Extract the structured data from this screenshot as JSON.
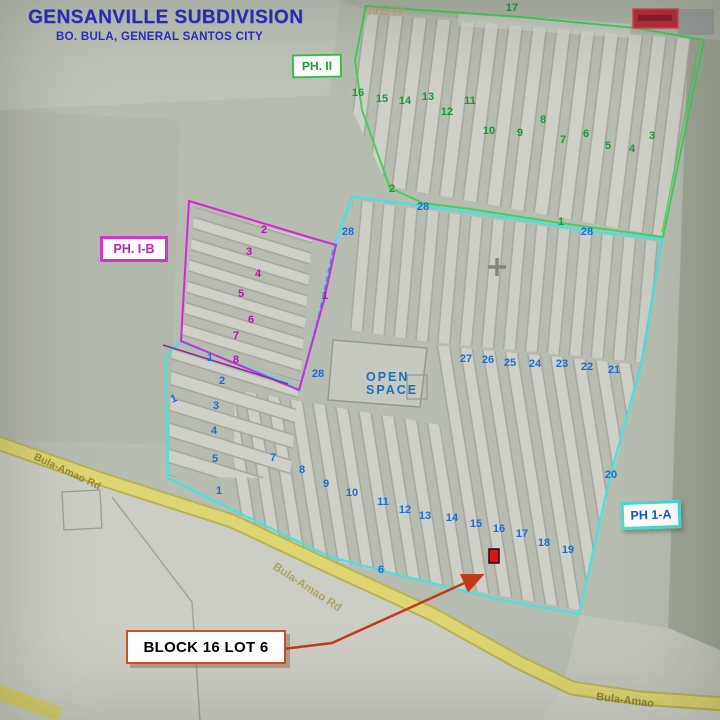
{
  "header": {
    "title": "GENSANVILLE SUBDIVISION",
    "subtitle": "BO. BULA, GENERAL SANTOS CITY"
  },
  "watermark": "NEW",
  "phases": {
    "ph2": {
      "label": "PH. II"
    },
    "ph1b": {
      "label": "PH. I-B"
    },
    "ph1a": {
      "label": "PH 1-A"
    }
  },
  "open_space": {
    "line1": "OPEN",
    "line2": "SPACE"
  },
  "roads": {
    "label_left": "Bula-Amao Rd",
    "label_mid": "Bula-Amao Rd",
    "label_right": "Bula-Amao"
  },
  "callout": {
    "label": "BLOCK 16 LOT 6"
  },
  "colors": {
    "title_blue": "#2a2ac8",
    "phase2_green": "#1f9e35",
    "phase1b_magenta": "#bb22bb",
    "phase1a_cyan": "#46d7d7",
    "block_number_green": "#1d9636",
    "block_number_blue": "#1e6cd4",
    "block_number_magenta": "#b314b3",
    "road_yellow": "#d9d26c",
    "arrow_red": "#c23a1a",
    "target_marker_red": "#e01010"
  },
  "markers": {
    "green": [
      {
        "label": "17",
        "x": 512,
        "y": 8
      },
      {
        "label": "16",
        "x": 358,
        "y": 93
      },
      {
        "label": "15",
        "x": 382,
        "y": 99
      },
      {
        "label": "14",
        "x": 405,
        "y": 101
      },
      {
        "label": "13",
        "x": 428,
        "y": 97
      },
      {
        "label": "12",
        "x": 447,
        "y": 112
      },
      {
        "label": "11",
        "x": 470,
        "y": 101
      },
      {
        "label": "10",
        "x": 489,
        "y": 131
      },
      {
        "label": "9",
        "x": 520,
        "y": 133
      },
      {
        "label": "8",
        "x": 543,
        "y": 120
      },
      {
        "label": "7",
        "x": 563,
        "y": 140
      },
      {
        "label": "6",
        "x": 586,
        "y": 134
      },
      {
        "label": "5",
        "x": 608,
        "y": 146
      },
      {
        "label": "4",
        "x": 632,
        "y": 149
      },
      {
        "label": "3",
        "x": 652,
        "y": 136
      },
      {
        "label": "2",
        "x": 392,
        "y": 189
      },
      {
        "label": "1",
        "x": 561,
        "y": 222
      }
    ],
    "blue": [
      {
        "label": "28",
        "x": 423,
        "y": 207
      },
      {
        "label": "28",
        "x": 348,
        "y": 232
      },
      {
        "label": "28",
        "x": 587,
        "y": 232
      },
      {
        "label": "28",
        "x": 318,
        "y": 374
      },
      {
        "label": "27",
        "x": 466,
        "y": 359
      },
      {
        "label": "26",
        "x": 488,
        "y": 360
      },
      {
        "label": "25",
        "x": 510,
        "y": 363
      },
      {
        "label": "24",
        "x": 535,
        "y": 364
      },
      {
        "label": "23",
        "x": 562,
        "y": 364
      },
      {
        "label": "22",
        "x": 587,
        "y": 367
      },
      {
        "label": "21",
        "x": 614,
        "y": 370
      },
      {
        "label": "20",
        "x": 611,
        "y": 475
      },
      {
        "label": "1",
        "x": 174,
        "y": 399,
        "r": -20
      },
      {
        "label": "1",
        "x": 210,
        "y": 358
      },
      {
        "label": "2",
        "x": 222,
        "y": 381
      },
      {
        "label": "3",
        "x": 216,
        "y": 406
      },
      {
        "label": "4",
        "x": 214,
        "y": 431
      },
      {
        "label": "5",
        "x": 215,
        "y": 459
      },
      {
        "label": "1",
        "x": 219,
        "y": 491
      },
      {
        "label": "7",
        "x": 273,
        "y": 458
      },
      {
        "label": "8",
        "x": 302,
        "y": 470
      },
      {
        "label": "9",
        "x": 326,
        "y": 484
      },
      {
        "label": "10",
        "x": 352,
        "y": 493
      },
      {
        "label": "11",
        "x": 383,
        "y": 502
      },
      {
        "label": "12",
        "x": 405,
        "y": 510
      },
      {
        "label": "13",
        "x": 425,
        "y": 516
      },
      {
        "label": "14",
        "x": 452,
        "y": 518
      },
      {
        "label": "15",
        "x": 476,
        "y": 524
      },
      {
        "label": "16",
        "x": 499,
        "y": 529
      },
      {
        "label": "17",
        "x": 522,
        "y": 534
      },
      {
        "label": "18",
        "x": 544,
        "y": 543
      },
      {
        "label": "19",
        "x": 568,
        "y": 550
      },
      {
        "label": "6",
        "x": 381,
        "y": 570
      }
    ],
    "magenta": [
      {
        "label": "2",
        "x": 264,
        "y": 230
      },
      {
        "label": "3",
        "x": 249,
        "y": 252
      },
      {
        "label": "4",
        "x": 258,
        "y": 274
      },
      {
        "label": "5",
        "x": 241,
        "y": 294
      },
      {
        "label": "6",
        "x": 251,
        "y": 320
      },
      {
        "label": "7",
        "x": 236,
        "y": 336
      },
      {
        "label": "8",
        "x": 236,
        "y": 360
      },
      {
        "label": "1",
        "x": 325,
        "y": 296
      }
    ]
  }
}
